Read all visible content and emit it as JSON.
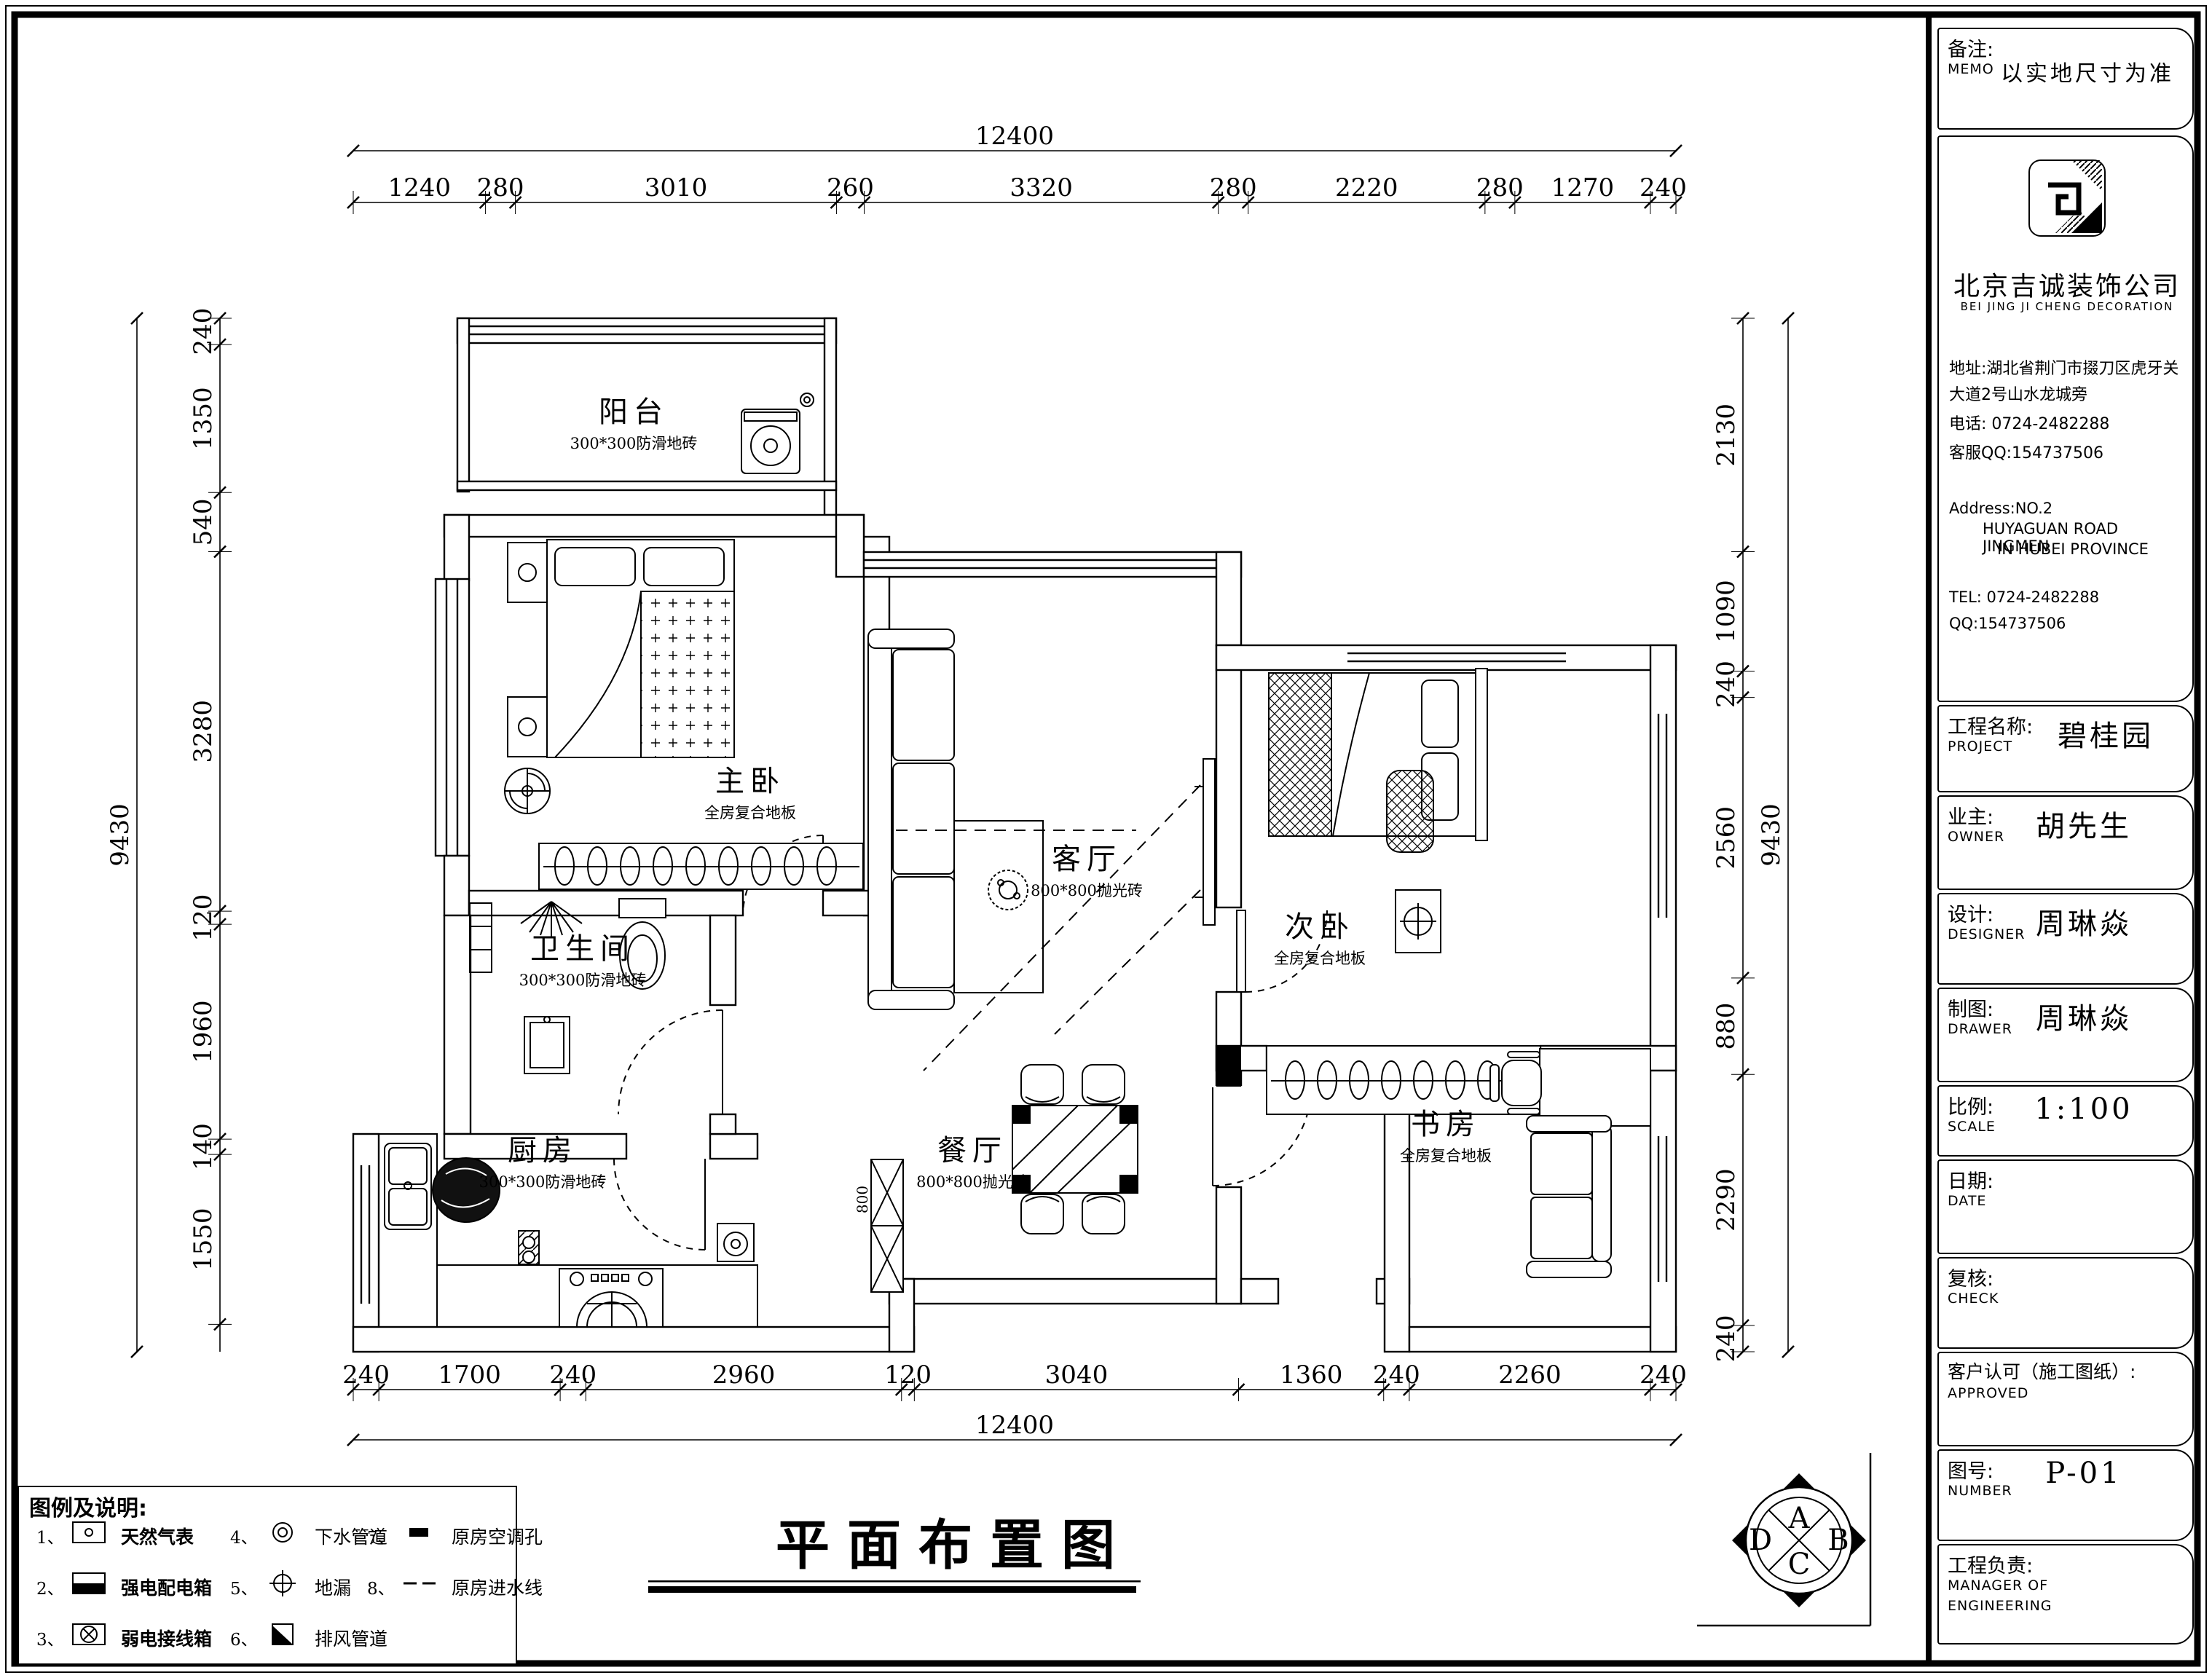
{
  "drawing_title": "平面布置图",
  "memo": {
    "label_cn": "备注:",
    "label_en": "MEMO",
    "value": "以实地尺寸为准"
  },
  "company": {
    "name": "北京吉诚装饰公司",
    "name_en": "BEI JING JI CHENG DECORATION",
    "address_line1": "地址:湖北省荆门市掇刀区虎牙关",
    "address_line2": "大道2号山水龙城旁",
    "phone": "电话: 0724-2482288",
    "qq": "客服QQ:154737506",
    "address_en_line1": "Address:NO.2",
    "address_en_line2": "HUYAGUAN ROAD JINGMEN",
    "address_en_line3": "IN HUBEI PROVINCE",
    "tel_en": "TEL: 0724-2482288",
    "qq_en": "QQ:154737506"
  },
  "title_block": {
    "project": {
      "label_cn": "工程名称:",
      "label_en": "PROJECT",
      "value": "碧桂园"
    },
    "owner": {
      "label_cn": "业主:",
      "label_en": "OWNER",
      "value": "胡先生"
    },
    "designer": {
      "label_cn": "设计:",
      "label_en": "DESIGNER",
      "value": "周琳焱"
    },
    "drawer": {
      "label_cn": "制图:",
      "label_en": "DRAWER",
      "value": "周琳焱"
    },
    "scale": {
      "label_cn": "比例:",
      "label_en": "SCALE",
      "value": "1:100"
    },
    "date": {
      "label_cn": "日期:",
      "label_en": "DATE",
      "value": ""
    },
    "check": {
      "label_cn": "复核:",
      "label_en": "CHECK",
      "value": ""
    },
    "approved": {
      "label_cn": "客户认可（施工图纸）:",
      "label_en": "APPROVED",
      "value": ""
    },
    "number": {
      "label_cn": "图号:",
      "label_en": "NUMBER",
      "value": "P-01"
    },
    "manager": {
      "label_cn": "工程负责:",
      "label_en": "MANAGER OF",
      "label_en2": "ENGINEERING",
      "value": ""
    }
  },
  "rooms": [
    {
      "name": "阳台",
      "floor": "300*300防滑地砖"
    },
    {
      "name": "主卧",
      "floor": "全房复合地板"
    },
    {
      "name": "卫生间",
      "floor": "300*300防滑地砖"
    },
    {
      "name": "厨房",
      "floor": "300*300防滑地砖"
    },
    {
      "name": "客厅",
      "floor": "800*800抛光砖"
    },
    {
      "name": "餐厅",
      "floor": "800*800抛光砖"
    },
    {
      "name": "次卧",
      "floor": "全房复合地板"
    },
    {
      "name": "书房",
      "floor": "全房复合地板"
    }
  ],
  "plan_notes": {
    "cabinet_width": "800"
  },
  "dimensions": {
    "top": {
      "overall": "12400",
      "segments": [
        "1240",
        "280",
        "3010",
        "260",
        "3320",
        "280",
        "2220",
        "280",
        "1270",
        "240"
      ]
    },
    "bottom": {
      "overall": "12400",
      "segments": [
        "240",
        "1700",
        "240",
        "2960",
        "120",
        "3040",
        "1360",
        "240",
        "2260",
        "240"
      ]
    },
    "left": {
      "overall": "9430",
      "segments": [
        "240",
        "1350",
        "540",
        "3280",
        "120",
        "1960",
        "140",
        "1550"
      ]
    },
    "right": {
      "overall": "9430",
      "segments": [
        "2130",
        "1090",
        "240",
        "2560",
        "880",
        "2290",
        "240"
      ]
    }
  },
  "legend": {
    "title": "图例及说明:",
    "items": [
      {
        "num": "1、",
        "icon": "gas-meter",
        "label": "天然气表",
        "bold": true
      },
      {
        "num": "2、",
        "icon": "power-distribution-box",
        "label": "强电配电箱",
        "bold": true
      },
      {
        "num": "3、",
        "icon": "weak-current-box",
        "label": "弱电接线箱",
        "bold": true
      },
      {
        "num": "4、",
        "icon": "drain-pipe",
        "label": "下水管道",
        "bold": false
      },
      {
        "num": "5、",
        "icon": "floor-drain",
        "label": "地漏",
        "bold": false
      },
      {
        "num": "6、",
        "icon": "exhaust-duct",
        "label": "排风管道",
        "bold": false
      },
      {
        "num": "7、",
        "icon": "ac-hole",
        "label": "原房空调孔",
        "bold": false
      },
      {
        "num": "8、",
        "icon": "water-line",
        "label": "原房进水线",
        "bold": false
      }
    ]
  },
  "compass": {
    "letters": [
      "A",
      "B",
      "C",
      "D"
    ]
  }
}
